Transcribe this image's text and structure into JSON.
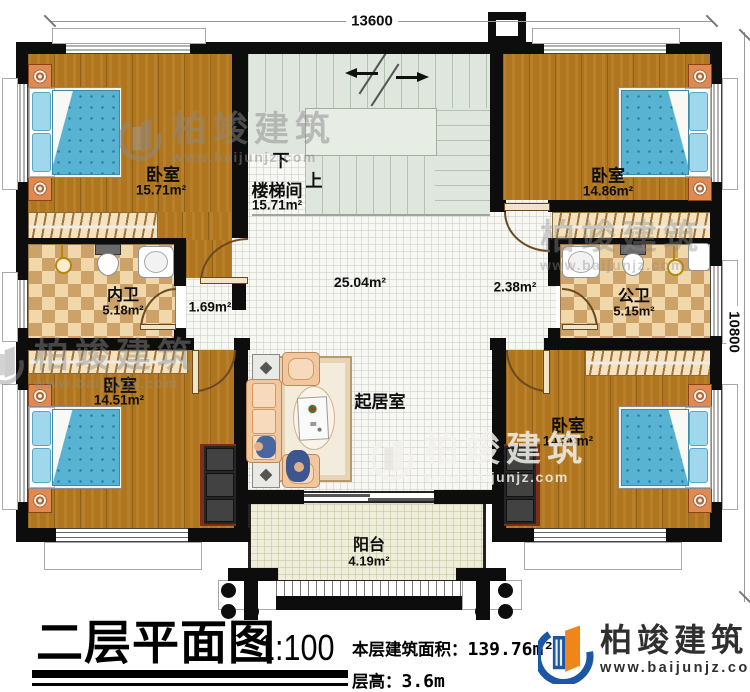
{
  "dimensions": {
    "top": "13600",
    "right": "10800"
  },
  "rooms": {
    "bedroom_tl": {
      "name": "卧室",
      "area": "15.71m²"
    },
    "stairwell": {
      "name": "楼梯间",
      "area": "15.71m²",
      "down": "下",
      "up": "上"
    },
    "bedroom_tr": {
      "name": "卧室",
      "area": "14.86m²"
    },
    "bath_inner": {
      "name": "内卫",
      "area": "5.18m²"
    },
    "hall_left": {
      "area": "1.69m²"
    },
    "living_area": {
      "area": "25.04m²"
    },
    "hall_right": {
      "area": "2.38m²"
    },
    "bath_public": {
      "name": "公卫",
      "area": "5.15m²"
    },
    "bedroom_bl": {
      "name": "卧室",
      "area": "14.51m²"
    },
    "living": {
      "name": "起居室"
    },
    "bedroom_br": {
      "name": "卧室",
      "area": "14.86m²"
    },
    "balcony": {
      "name": "阳台",
      "area": "4.19m²"
    }
  },
  "titleblock": {
    "title": "二层平面图",
    "scale": "1:100",
    "area_label": "本层建筑面积：",
    "area_value": "139.76m²",
    "height_label": "层高：",
    "height_value": "3.6m"
  },
  "brand": {
    "name": "柏竣建筑",
    "url": "www.baijunjz.com"
  },
  "watermark": {
    "name": "柏竣建筑",
    "url": "www.baijunjz.com"
  },
  "colors": {
    "wall": "#0d0d0d",
    "wood": "#b0761f",
    "tile_light": "#f0d8ab",
    "tile_dark": "#cda268",
    "stair": "#dfe6de",
    "balcony": "#eeeedb",
    "bed_blue": "#58b2d2",
    "sofa_peach": "#f0c79f",
    "brand_blue": "#1c57a5",
    "brand_orange": "#f08519"
  }
}
